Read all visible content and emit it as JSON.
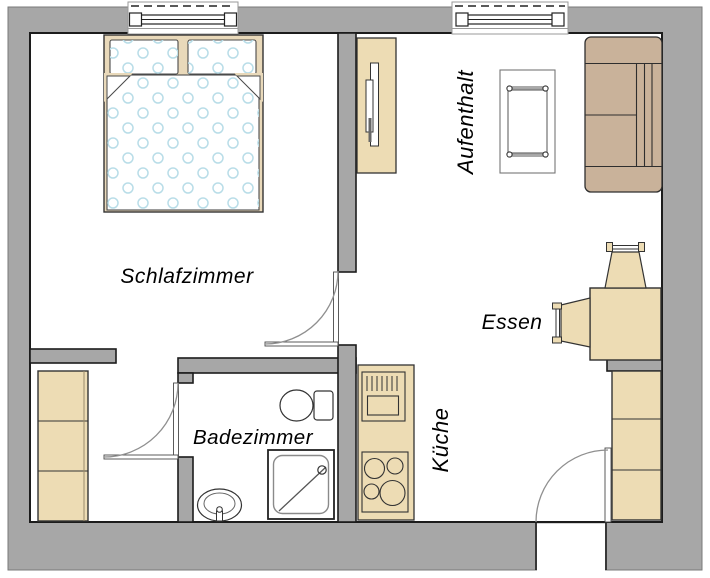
{
  "diagram": {
    "type": "apartment-floor-plan",
    "rooms": {
      "bedroom": {
        "label": "Schlafzimmer"
      },
      "living": {
        "label": "Aufenthalt"
      },
      "dining": {
        "label": "Essen"
      },
      "kitchen": {
        "label": "Küche"
      },
      "bathroom": {
        "label": "Badezimmer"
      }
    },
    "colors": {
      "wall": "#a7a7a7",
      "outline": "#1c1c1c",
      "furniture": "#eddcb4",
      "sofa": "#c9b29a",
      "bed_frame": "#e9d9ba",
      "bed_pattern_dots": "#b9dde8",
      "floor": "#ffffff"
    },
    "furniture": [
      "double-bed",
      "pillows",
      "duvet",
      "hall-wardrobe",
      "tv-sideboard",
      "tv",
      "coffee-table",
      "sofa",
      "dining-table",
      "dining-chair-north",
      "dining-chair-west",
      "entry-wardrobe",
      "kitchen-counter",
      "kitchen-sink",
      "stove",
      "toilet",
      "wash-basin",
      "shower"
    ],
    "openings": [
      "bedroom-window",
      "living-window",
      "bedroom-door",
      "bathroom-door",
      "entry-door",
      "hall-passage"
    ]
  }
}
